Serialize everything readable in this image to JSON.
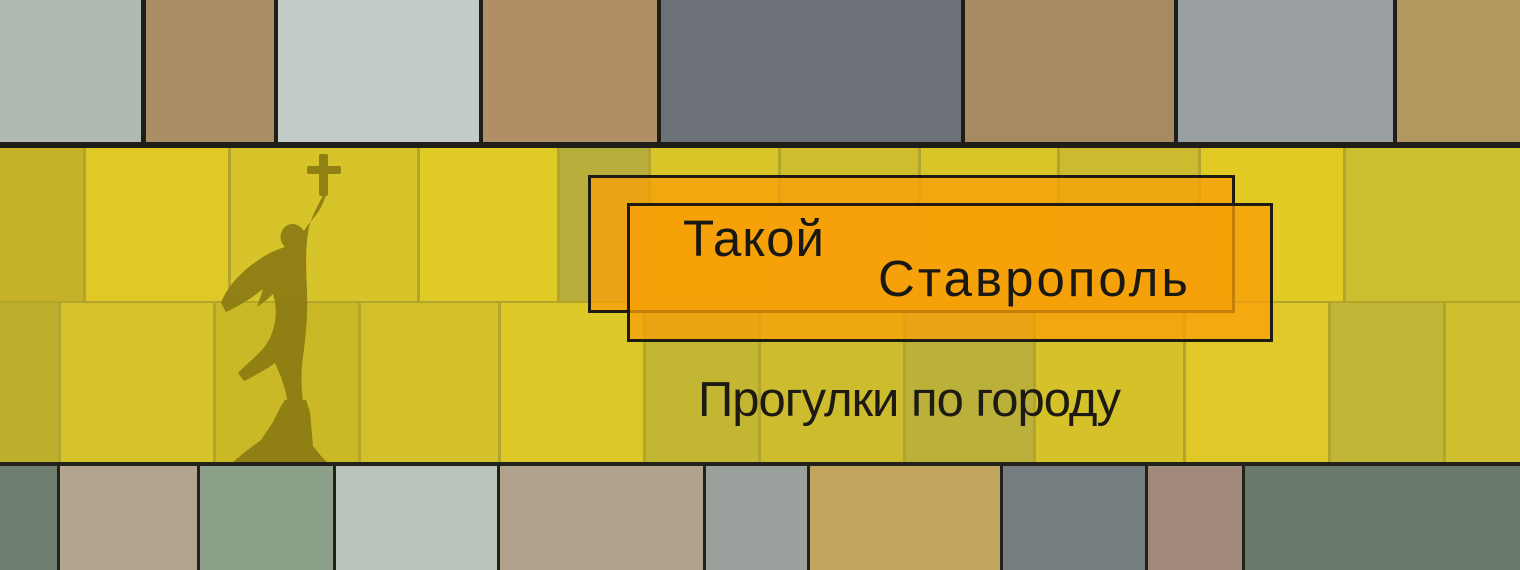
{
  "banner": {
    "title_line1": "Такой",
    "title_line2": "Ставрополь",
    "subtitle": "Прогулки по городу",
    "icons": [
      {
        "name": "angel-statue-silhouette-icon",
        "meaning": "silhouette of the Stavropol guardian-angel monument holding a raised cross"
      }
    ],
    "colors": {
      "band_yellow": "#d5c12c",
      "box_orange_overlap": "#f5a10b",
      "box_orange_single": "#efa711",
      "outline_black": "#1e1b13",
      "text_black": "#191813",
      "statue_olive": "#8c7b12"
    }
  },
  "background": {
    "top_row": {
      "gap_color": "#201e19",
      "bricks": [
        {
          "x": 0,
          "w": 141,
          "c": "#b0bab0"
        },
        {
          "x": 146,
          "w": 128,
          "c": "#a98e66"
        },
        {
          "x": 278,
          "w": 201,
          "c": "#c4ccc9"
        },
        {
          "x": 483,
          "w": 174,
          "c": "#b08f66"
        },
        {
          "x": 661,
          "w": 300,
          "c": "#6d7278"
        },
        {
          "x": 965,
          "w": 209,
          "c": "#a68b62"
        },
        {
          "x": 1178,
          "w": 215,
          "c": "#9aa0a2"
        },
        {
          "x": 1397,
          "w": 123,
          "c": "#b2985f"
        }
      ]
    },
    "bottom_row": {
      "gap_color": "#23211c",
      "bricks": [
        {
          "x": 0,
          "w": 57,
          "c": "#6e7d6d"
        },
        {
          "x": 60,
          "w": 137,
          "c": "#b4a48f"
        },
        {
          "x": 200,
          "w": 133,
          "c": "#8da089"
        },
        {
          "x": 336,
          "w": 161,
          "c": "#bac3ba"
        },
        {
          "x": 500,
          "w": 203,
          "c": "#b2a28d"
        },
        {
          "x": 706,
          "w": 101,
          "c": "#9aa19c"
        },
        {
          "x": 810,
          "w": 190,
          "c": "#c2a55e"
        },
        {
          "x": 1003,
          "w": 142,
          "c": "#767d81"
        },
        {
          "x": 1148,
          "w": 94,
          "c": "#a18a7b"
        },
        {
          "x": 1245,
          "w": 275,
          "c": "#69796c"
        }
      ]
    },
    "band": {
      "seam_color": "#b3a42c",
      "rows": [
        {
          "y": 0,
          "h": 153,
          "bricks": [
            {
              "x": 0,
              "w": 83,
              "c": "#c6b228"
            },
            {
              "x": 86,
              "w": 142,
              "c": "#e0c927"
            },
            {
              "x": 231,
              "w": 186,
              "c": "#d7c32a"
            },
            {
              "x": 420,
              "w": 137,
              "c": "#e0ca26"
            },
            {
              "x": 560,
              "w": 88,
              "c": "#b7ae3b"
            },
            {
              "x": 651,
              "w": 127,
              "c": "#d9c528"
            },
            {
              "x": 781,
              "w": 137,
              "c": "#cfbd2e"
            },
            {
              "x": 921,
              "w": 136,
              "c": "#d9c527"
            },
            {
              "x": 1060,
              "w": 138,
              "c": "#ccba31"
            },
            {
              "x": 1201,
              "w": 142,
              "c": "#e2ca25"
            },
            {
              "x": 1346,
              "w": 174,
              "c": "#ccbe2e"
            }
          ]
        },
        {
          "y": 155,
          "h": 159,
          "bricks": [
            {
              "x": 0,
              "w": 58,
              "c": "#bfae2e"
            },
            {
              "x": 61,
              "w": 152,
              "c": "#d6c22b"
            },
            {
              "x": 216,
              "w": 142,
              "c": "#cab827"
            },
            {
              "x": 361,
              "w": 137,
              "c": "#d3c02b"
            },
            {
              "x": 501,
              "w": 142,
              "c": "#dcc826"
            },
            {
              "x": 646,
              "w": 112,
              "c": "#c3b632"
            },
            {
              "x": 761,
              "w": 142,
              "c": "#cebc2f"
            },
            {
              "x": 906,
              "w": 127,
              "c": "#bbb13a"
            },
            {
              "x": 1036,
              "w": 147,
              "c": "#d5c22a"
            },
            {
              "x": 1186,
              "w": 142,
              "c": "#dfc827"
            },
            {
              "x": 1331,
              "w": 112,
              "c": "#c2b636"
            },
            {
              "x": 1446,
              "w": 74,
              "c": "#cfbe2e"
            }
          ]
        }
      ]
    }
  }
}
